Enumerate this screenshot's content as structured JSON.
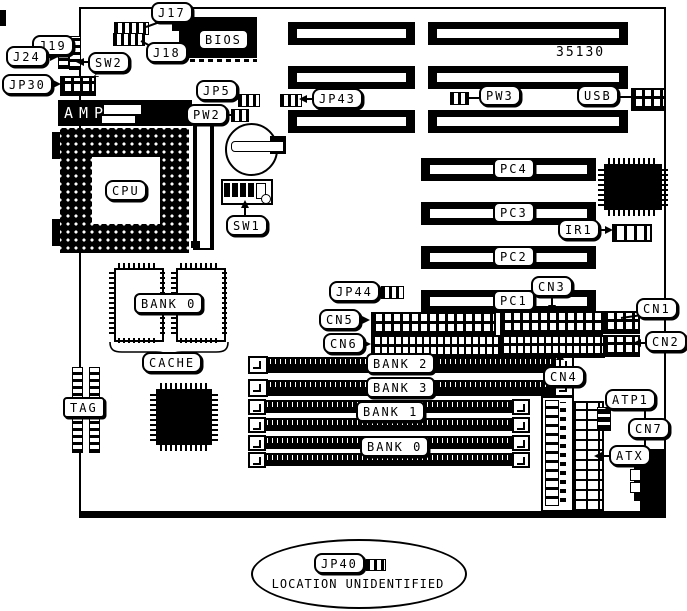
{
  "board": {
    "part_number": "35130"
  },
  "callouts": {
    "j17": "J17",
    "j18": "J18",
    "j19": "J19",
    "j24": "J24",
    "sw2": "SW2",
    "jp30": "JP30",
    "jp30_note": "2",
    "jp5": "JP5",
    "pw2": "PW2",
    "jp43": "JP43",
    "pw3": "PW3",
    "usb": "USB",
    "sw1": "SW1",
    "ir1": "IR1",
    "jp44": "JP44",
    "cn1": "CN1",
    "cn2": "CN2",
    "cn3": "CN3",
    "cn4": "CN4",
    "cn5": "CN5",
    "cn6": "CN6",
    "cn7": "CN7",
    "atp1": "ATP1",
    "atx": "ATX"
  },
  "chips": {
    "bios": "BIOS",
    "amp": "AMP",
    "cpu": "CPU",
    "tag": "TAG",
    "cache": "CACHE",
    "cache_bank": "BANK 0"
  },
  "slots": {
    "pci": [
      "PC4",
      "PC3",
      "PC2",
      "PC1"
    ],
    "simm_upper": [
      "BANK 2",
      "BANK 3"
    ],
    "simm_lower": [
      "BANK 1",
      "BANK 0"
    ]
  },
  "note": {
    "jumper": "JP40",
    "text": "LOCATION UNIDENTIFIED"
  },
  "colors": {
    "ink": "#000000",
    "paper": "#ffffff"
  }
}
